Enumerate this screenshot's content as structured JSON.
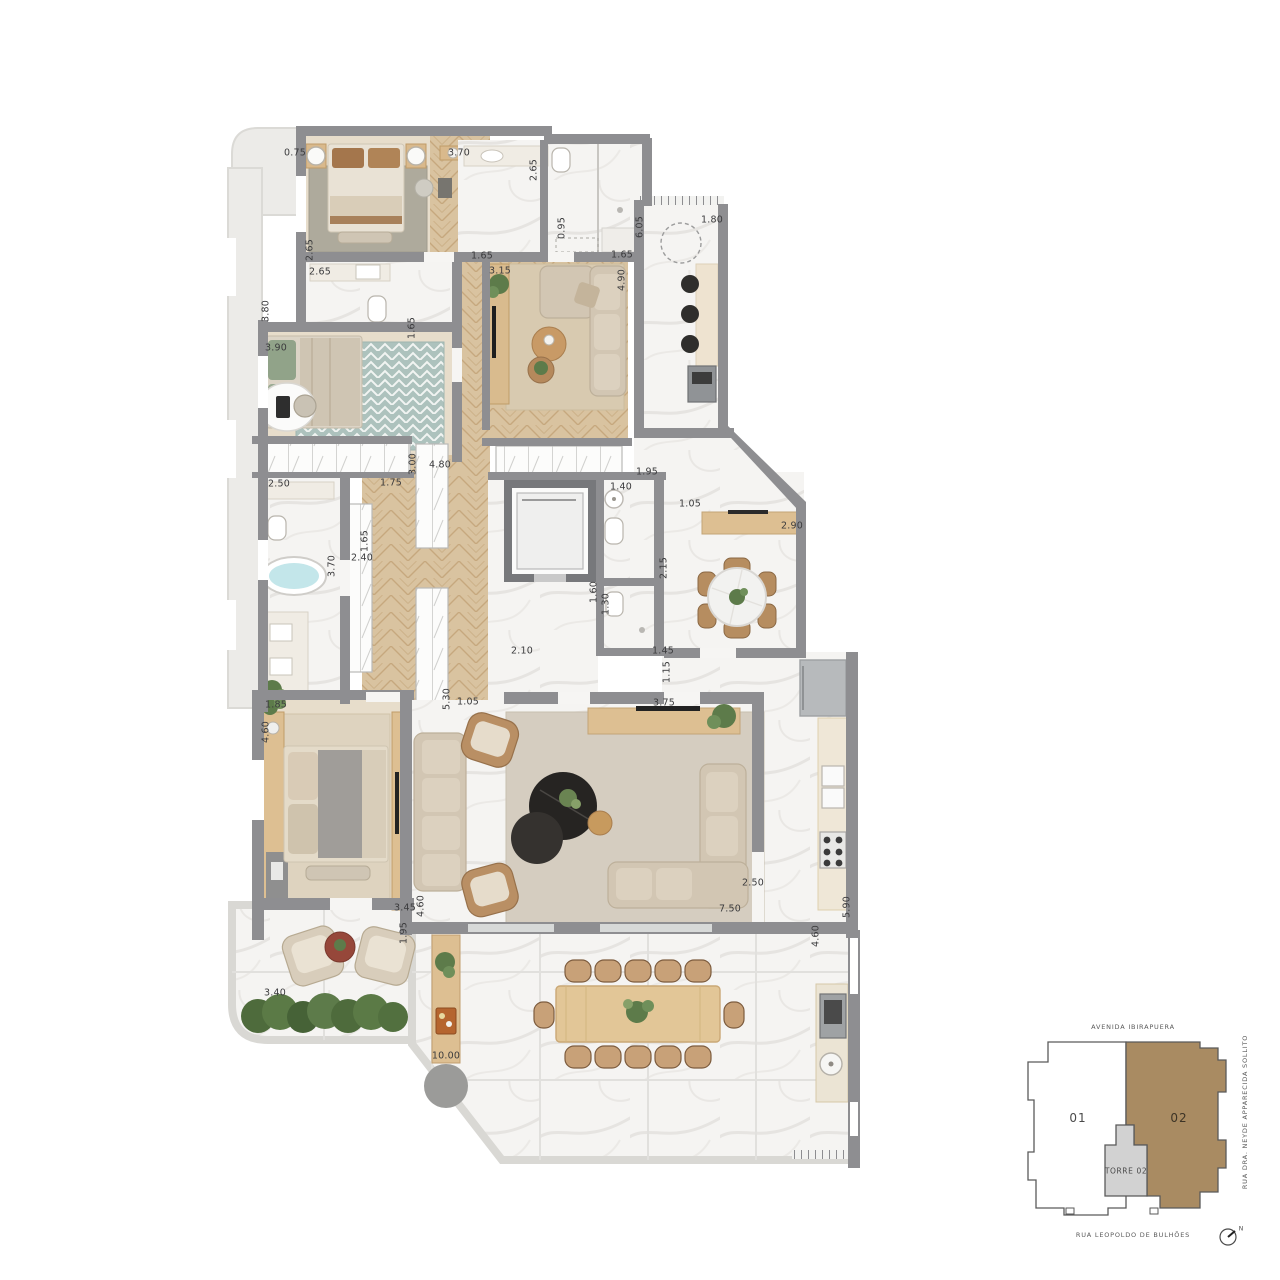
{
  "plan": {
    "type": "apartment-floor-plan",
    "colors": {
      "wall": "#8e8e91",
      "wood": "#d9c3a0",
      "wood_dark": "#c6a87e",
      "marble": "#f5f4f2",
      "slab": "#ecebe8",
      "rug_family": "#d8cab0",
      "rug_living": "#d5cdc0",
      "rug_bed1": "#aeaa9c",
      "rug_teal": "#adc2bd",
      "water": "#c3e6ea",
      "plant_green": "#5d7b4a",
      "furniture_wood": "#ddbf92",
      "keyplan_unit02": "#a98b62",
      "keyplan_tower": "#d2d2d2"
    },
    "dimensions": [
      {
        "v": "0.75",
        "x": 295,
        "y": 153,
        "r": 0
      },
      {
        "v": "3.70",
        "x": 459,
        "y": 153,
        "r": 0
      },
      {
        "v": "2.65",
        "x": 534,
        "y": 170,
        "r": -90
      },
      {
        "v": "1.65",
        "x": 482,
        "y": 256,
        "r": 0
      },
      {
        "v": "3.15",
        "x": 500,
        "y": 271,
        "r": 0
      },
      {
        "v": "1.65",
        "x": 622,
        "y": 255,
        "r": 0
      },
      {
        "v": "0.95",
        "x": 562,
        "y": 228,
        "r": -90
      },
      {
        "v": "6.05",
        "x": 640,
        "y": 227,
        "r": -90
      },
      {
        "v": "1.80",
        "x": 712,
        "y": 220,
        "r": 0
      },
      {
        "v": "4.90",
        "x": 622,
        "y": 280,
        "r": -90
      },
      {
        "v": "2.65",
        "x": 310,
        "y": 250,
        "r": -90
      },
      {
        "v": "2.65",
        "x": 320,
        "y": 272,
        "r": 0
      },
      {
        "v": "3.80",
        "x": 266,
        "y": 311,
        "r": -90
      },
      {
        "v": "3.90",
        "x": 276,
        "y": 348,
        "r": 0
      },
      {
        "v": "1.65",
        "x": 412,
        "y": 328,
        "r": -90
      },
      {
        "v": "3.00",
        "x": 413,
        "y": 464,
        "r": -90
      },
      {
        "v": "4.80",
        "x": 440,
        "y": 465,
        "r": 0
      },
      {
        "v": "2.50",
        "x": 279,
        "y": 484,
        "r": 0
      },
      {
        "v": "1.75",
        "x": 391,
        "y": 483,
        "r": 0
      },
      {
        "v": "1.95",
        "x": 647,
        "y": 472,
        "r": 0
      },
      {
        "v": "1.40",
        "x": 621,
        "y": 487,
        "r": 0
      },
      {
        "v": "2.40",
        "x": 362,
        "y": 558,
        "r": 0
      },
      {
        "v": "3.70",
        "x": 332,
        "y": 566,
        "r": -90
      },
      {
        "v": "1.65",
        "x": 365,
        "y": 541,
        "r": -90
      },
      {
        "v": "2.90",
        "x": 792,
        "y": 526,
        "r": 0
      },
      {
        "v": "1.05",
        "x": 690,
        "y": 504,
        "r": 0
      },
      {
        "v": "2.15",
        "x": 664,
        "y": 568,
        "r": -90
      },
      {
        "v": "1.60",
        "x": 594,
        "y": 592,
        "r": -90
      },
      {
        "v": "1.30",
        "x": 606,
        "y": 604,
        "r": -90
      },
      {
        "v": "2.10",
        "x": 522,
        "y": 651,
        "r": 0
      },
      {
        "v": "1.45",
        "x": 663,
        "y": 651,
        "r": 0
      },
      {
        "v": "1.15",
        "x": 667,
        "y": 672,
        "r": -90
      },
      {
        "v": "1.85",
        "x": 276,
        "y": 705,
        "r": 0
      },
      {
        "v": "4.60",
        "x": 266,
        "y": 732,
        "r": -90
      },
      {
        "v": "5.30",
        "x": 447,
        "y": 699,
        "r": -90
      },
      {
        "v": "1.05",
        "x": 468,
        "y": 702,
        "r": 0
      },
      {
        "v": "3.75",
        "x": 664,
        "y": 703,
        "r": 0
      },
      {
        "v": "2.50",
        "x": 753,
        "y": 883,
        "r": 0
      },
      {
        "v": "7.50",
        "x": 730,
        "y": 909,
        "r": 0
      },
      {
        "v": "5.90",
        "x": 847,
        "y": 907,
        "r": -90
      },
      {
        "v": "3.45",
        "x": 405,
        "y": 908,
        "r": 0
      },
      {
        "v": "4.60",
        "x": 421,
        "y": 906,
        "r": -90
      },
      {
        "v": "1.95",
        "x": 404,
        "y": 933,
        "r": -90
      },
      {
        "v": "4.60",
        "x": 816,
        "y": 936,
        "r": -90
      },
      {
        "v": "3.40",
        "x": 275,
        "y": 993,
        "r": 0
      },
      {
        "v": "10.00",
        "x": 446,
        "y": 1056,
        "r": 0
      }
    ]
  },
  "keyplan": {
    "street_top": "AVENIDA IBIRAPUERA",
    "street_right": "RUA DRA. NEYDE APPARECIDA SOLLITO",
    "street_bottom": "RUA LEOPOLDO DE BULHÕES",
    "unit_left_label": "01",
    "unit_right_label": "02",
    "tower_label": "TORRE 02",
    "north_label": "N"
  }
}
